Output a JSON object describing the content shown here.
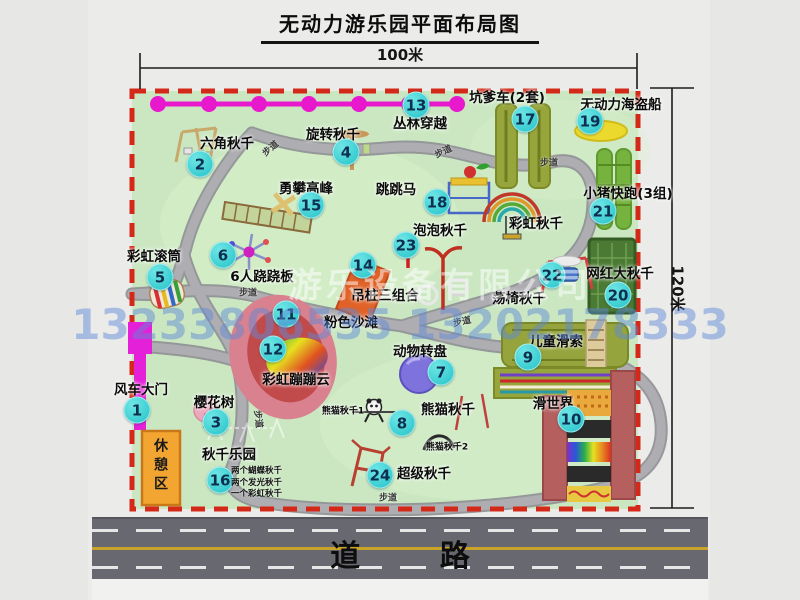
{
  "title": "无动力游乐园平面布局图",
  "dim_top": "100米",
  "dim_right": "120米",
  "road_label": "道  路",
  "trail_label": "步道",
  "rest_area": "休憩区",
  "watermark_company": "游乐设备有限公司",
  "watermark_phone": "13233806535 13202178333",
  "swing_notes": [
    "两个蝴蝶秋千",
    "两个发光秋千",
    "一个彩虹秋千"
  ],
  "colors": {
    "map_bg": "#cbe7c2",
    "border_dashed": "#d42818",
    "path_gray": "#a6a6aa",
    "badge_cyan": "#38ccd0",
    "zipline_magenta": "#e818cc",
    "gate_magenta": "#e420d8",
    "rest_area_orange": "#f2a531",
    "road_gray": "#686870",
    "road_line_yellow": "#caa32a"
  },
  "spots": [
    {
      "num": "1",
      "label": "风车大门",
      "x": 141,
      "y": 388,
      "bx": 137,
      "by": 410
    },
    {
      "num": "2",
      "label": "六角秋千",
      "x": 227,
      "y": 142,
      "bx": 200,
      "by": 164
    },
    {
      "num": "3",
      "label": "樱花树",
      "x": 214,
      "y": 401,
      "bx": 216,
      "by": 422
    },
    {
      "num": "4",
      "label": "旋转秋千",
      "x": 333,
      "y": 133,
      "bx": 346,
      "by": 152
    },
    {
      "num": "5",
      "label": "彩虹滚筒",
      "x": 154,
      "y": 255,
      "bx": 160,
      "by": 277
    },
    {
      "num": "6",
      "label": "6人跷跷板",
      "x": 262,
      "y": 275,
      "bx": 223,
      "by": 255
    },
    {
      "num": "7",
      "label": "动物转盘",
      "x": 420,
      "y": 350,
      "bx": 441,
      "by": 372
    },
    {
      "num": "8",
      "label": "熊猫秋千",
      "x": 448,
      "y": 408,
      "bx": 402,
      "by": 423
    },
    {
      "num": "9",
      "label": "儿童滑索",
      "x": 556,
      "y": 340,
      "bx": 528,
      "by": 357
    },
    {
      "num": "10",
      "label": "滑世界",
      "x": 553,
      "y": 402,
      "bx": 571,
      "by": 419
    },
    {
      "num": "11",
      "label": "粉色沙滩",
      "x": 351,
      "y": 321,
      "bx": 286,
      "by": 314
    },
    {
      "num": "12",
      "label": "彩虹蹦蹦云",
      "x": 296,
      "y": 378,
      "bx": 273,
      "by": 349
    },
    {
      "num": "13",
      "label": "丛林穿越",
      "x": 420,
      "y": 122,
      "bx": 416,
      "by": 105
    },
    {
      "num": "14",
      "label": "吊桩三组合",
      "x": 385,
      "y": 294,
      "bx": 363,
      "by": 265
    },
    {
      "num": "15",
      "label": "勇攀高峰",
      "x": 306,
      "y": 187,
      "bx": 311,
      "by": 205
    },
    {
      "num": "16",
      "label": "秋千乐园",
      "x": 229,
      "y": 453,
      "bx": 220,
      "by": 480
    },
    {
      "num": "17",
      "label": "坑爹车(2套)",
      "x": 507,
      "y": 96,
      "bx": 525,
      "by": 119
    },
    {
      "num": "18",
      "label": "跳跳马",
      "x": 396,
      "y": 188,
      "bx": 437,
      "by": 202
    },
    {
      "num": "19",
      "label": "无动力海盗船",
      "x": 621,
      "y": 103,
      "bx": 590,
      "by": 121
    },
    {
      "num": "20",
      "label": "网红大秋千",
      "x": 620,
      "y": 272,
      "bx": 618,
      "by": 295
    },
    {
      "num": "21",
      "label": "小猪快跑(3组)",
      "x": 628,
      "y": 192,
      "bx": 603,
      "by": 211
    },
    {
      "num": "22",
      "label": "荡椅秋千",
      "x": 519,
      "y": 297,
      "bx": 552,
      "by": 275
    },
    {
      "num": "23",
      "label": "泡泡秋千",
      "x": 440,
      "y": 229,
      "bx": 406,
      "by": 245
    },
    {
      "num": "24",
      "label": "超级秋千",
      "x": 424,
      "y": 472,
      "bx": 380,
      "by": 475
    },
    {
      "num": "",
      "label": "彩虹秋千",
      "x": 536,
      "y": 222
    },
    {
      "num": "",
      "label": "熊猫秋千1",
      "x": 343,
      "y": 410,
      "small": true
    },
    {
      "num": "",
      "label": "熊猫秋千2",
      "x": 447,
      "y": 446,
      "small": true
    }
  ],
  "trails": [
    {
      "x": 270,
      "y": 148,
      "r": -40
    },
    {
      "x": 443,
      "y": 151,
      "r": -25
    },
    {
      "x": 549,
      "y": 162,
      "r": 0
    },
    {
      "x": 248,
      "y": 292,
      "r": 0
    },
    {
      "x": 462,
      "y": 321,
      "r": -12
    },
    {
      "x": 259,
      "y": 419,
      "r": 83
    },
    {
      "x": 388,
      "y": 497,
      "r": 0
    }
  ]
}
